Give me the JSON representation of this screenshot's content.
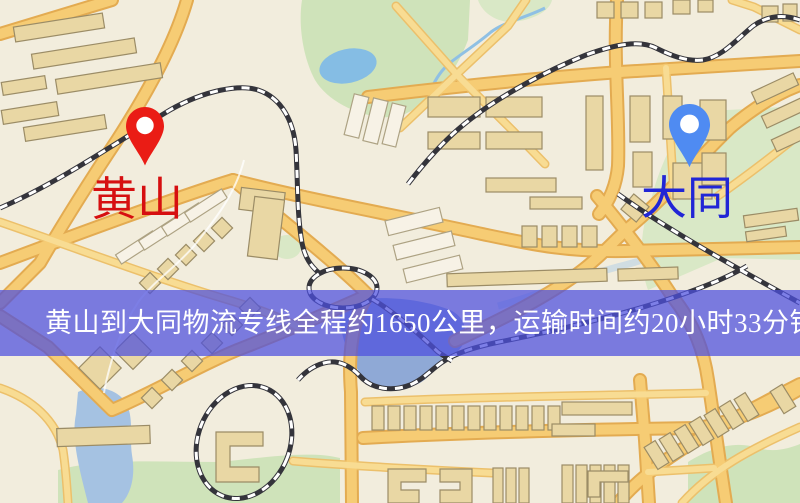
{
  "banner": {
    "text": "黄山到大同物流专线全程约1650公里，运输时间约20小时33分钟.",
    "background_color": "#4d50de",
    "text_color": "#ffffff"
  },
  "markers": {
    "origin": {
      "label": "黄山",
      "pin_color": "#ea1c15",
      "label_color": "#d60f10",
      "icon": "red-map-pin-icon"
    },
    "destination": {
      "label": "大同",
      "pin_color": "#4f8bf2",
      "label_color": "#2126d6",
      "icon": "blue-map-pin-icon"
    }
  },
  "map": {
    "background_color": "#f2eddd",
    "road_color": "#f6cc74",
    "road_casing_color": "#e3ab51",
    "building_color": "#e9d7a4",
    "park_color": "#cfe3ba",
    "water_color": "#8fa9d6",
    "railway_color": "#34343b"
  }
}
